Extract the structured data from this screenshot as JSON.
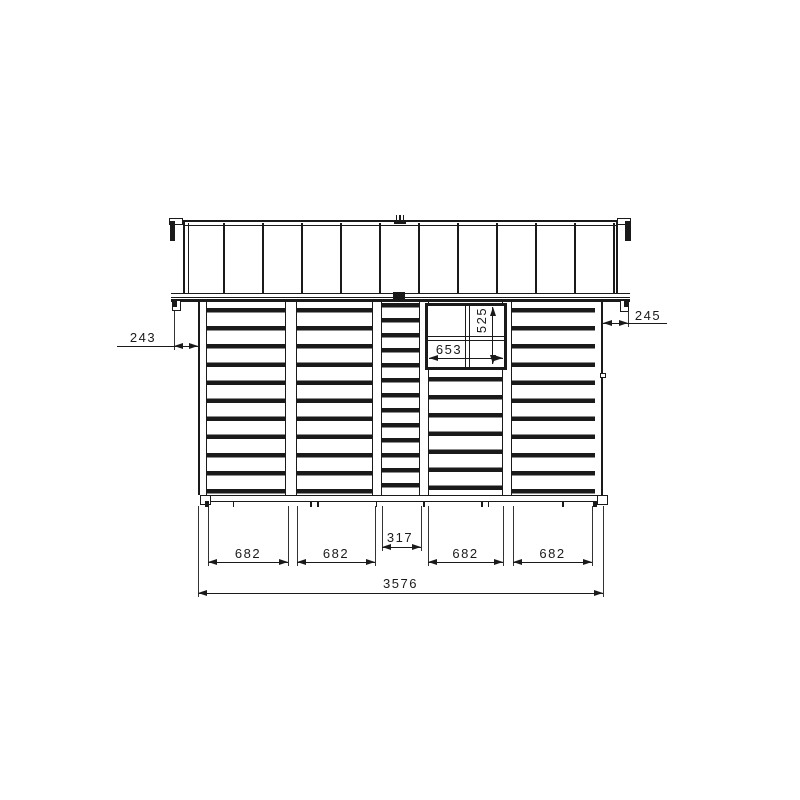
{
  "drawing": {
    "line_color": "#1a1a1a",
    "dims": {
      "left_overhang": "243",
      "right_overhang": "245",
      "window_w": "653",
      "window_h": "525",
      "bottom_segments": [
        "682",
        "682",
        "317",
        "682",
        "682"
      ],
      "total_width": "3576"
    }
  }
}
